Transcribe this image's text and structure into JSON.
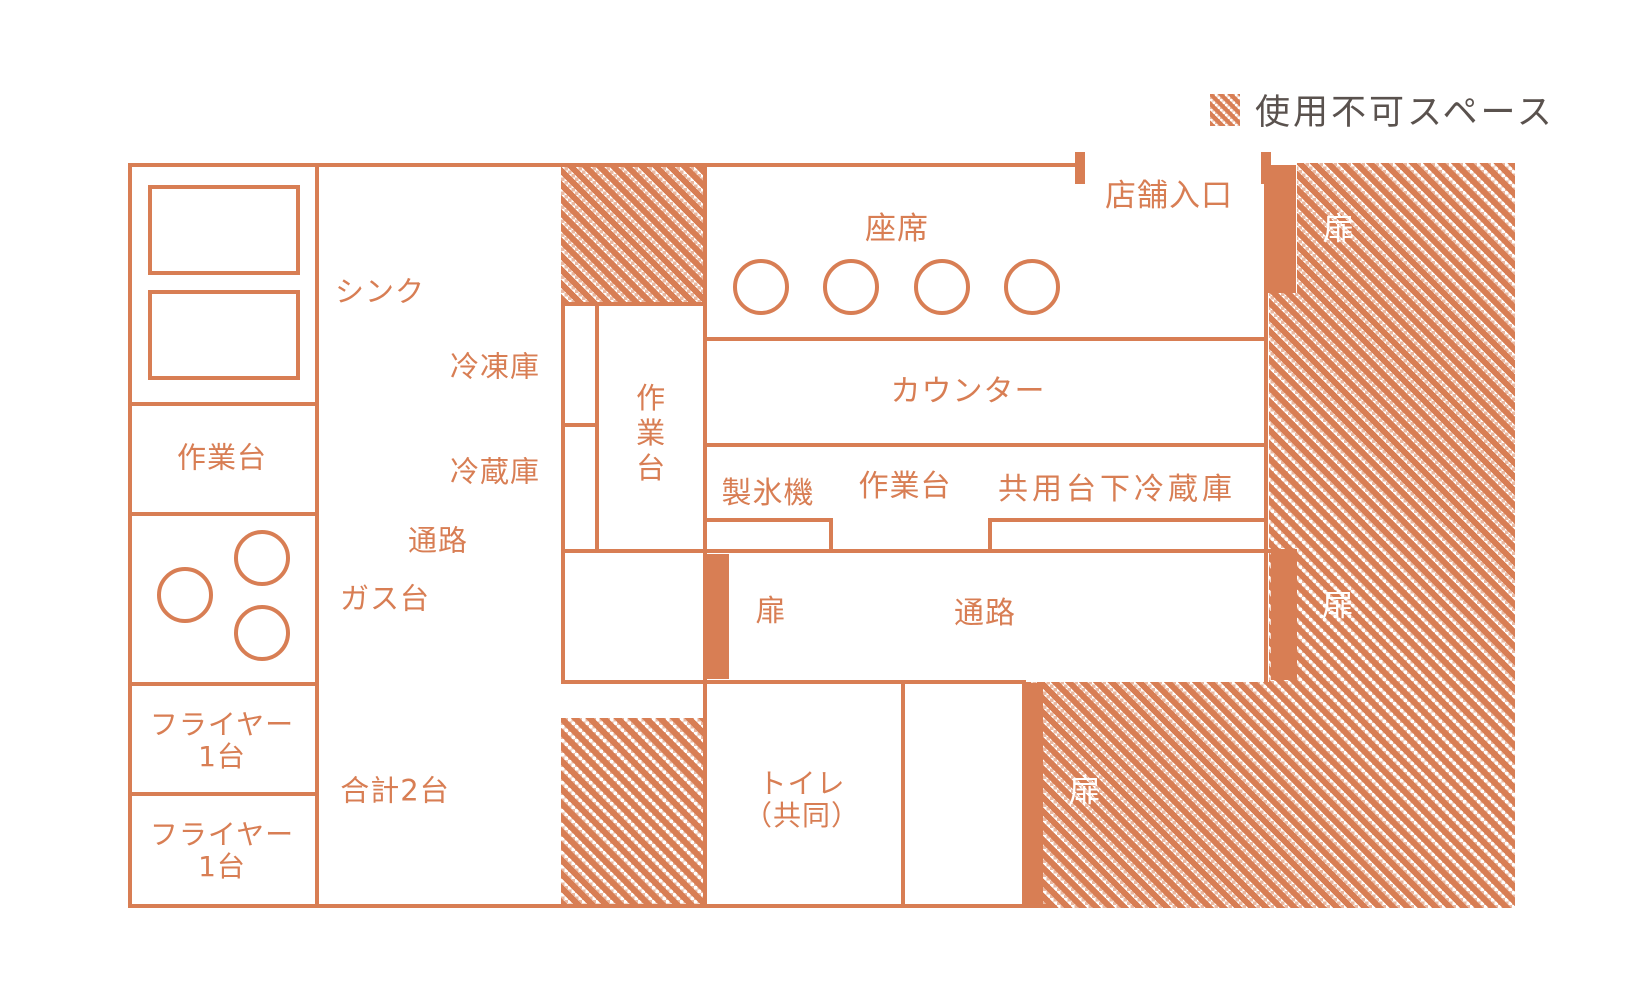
{
  "colors": {
    "accent": "#D87E54",
    "legend_text": "#5A524E",
    "background": "#FFFFFF",
    "hatch_stripe": "#FFFFFF"
  },
  "legend": {
    "label": "使用不可スペース"
  },
  "labels": {
    "sink": "シンク",
    "work_table_left": "作業台",
    "freezer": "冷凍庫",
    "fridge": "冷蔵庫",
    "aisle_kitchen": "通路",
    "gas_stove": "ガス台",
    "fryer_line1": "フライヤー",
    "fryer_line2": "1台",
    "total_units": "合計2台",
    "work_table_center": "作業台",
    "seats": "座席",
    "shop_entrance": "店舗入口",
    "counter": "カウンター",
    "ice_machine": "製氷機",
    "work_table_right": "作業台",
    "shared_under_counter_fridge": "共用台下冷蔵庫",
    "corridor": "通路",
    "door": "扉",
    "toilet_line1": "トイレ",
    "toilet_line2": "（共同）"
  },
  "counts": {
    "seat_circles": 4,
    "gas_burners": 3,
    "sink_basins": 2,
    "fryer_units_total": 2,
    "door_labels": 4
  }
}
